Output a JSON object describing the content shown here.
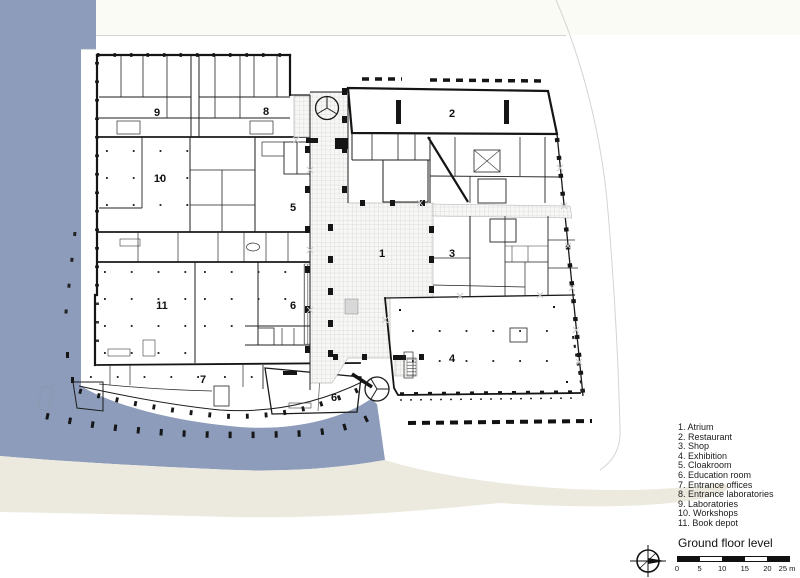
{
  "title": "Ground floor level",
  "legend": {
    "items": [
      "1. Atrium",
      "2. Restaurant",
      "3. Shop",
      "4. Exhibition",
      "5. Cloakroom",
      "6. Education room",
      "7. Entrance offices",
      "8. Entrance laboratories",
      "9. Laboratories",
      "10. Workshops",
      "11. Book depot"
    ]
  },
  "plan_labels": {
    "atrium": "1",
    "restaurant": "2",
    "shop": "3",
    "exhibition": "4",
    "cloakroom": "5",
    "education_room": "6",
    "education_room_annex": "6",
    "entrance_offices": "7",
    "entrance_laboratories": "8",
    "laboratories": "9",
    "workshops": "10",
    "book_depot": "11"
  },
  "scalebar": {
    "tick_labels": [
      "0",
      "5",
      "10",
      "15",
      "20",
      "25 m"
    ]
  },
  "colors": {
    "water": "#8C9CBA",
    "sand": "#ECEADF",
    "wall": "#151515",
    "grid_line": "#c7c7c7"
  },
  "icons": {
    "north_arrow": "circle-crosshair-needle",
    "revolving_door": "circle-with-spokes"
  }
}
